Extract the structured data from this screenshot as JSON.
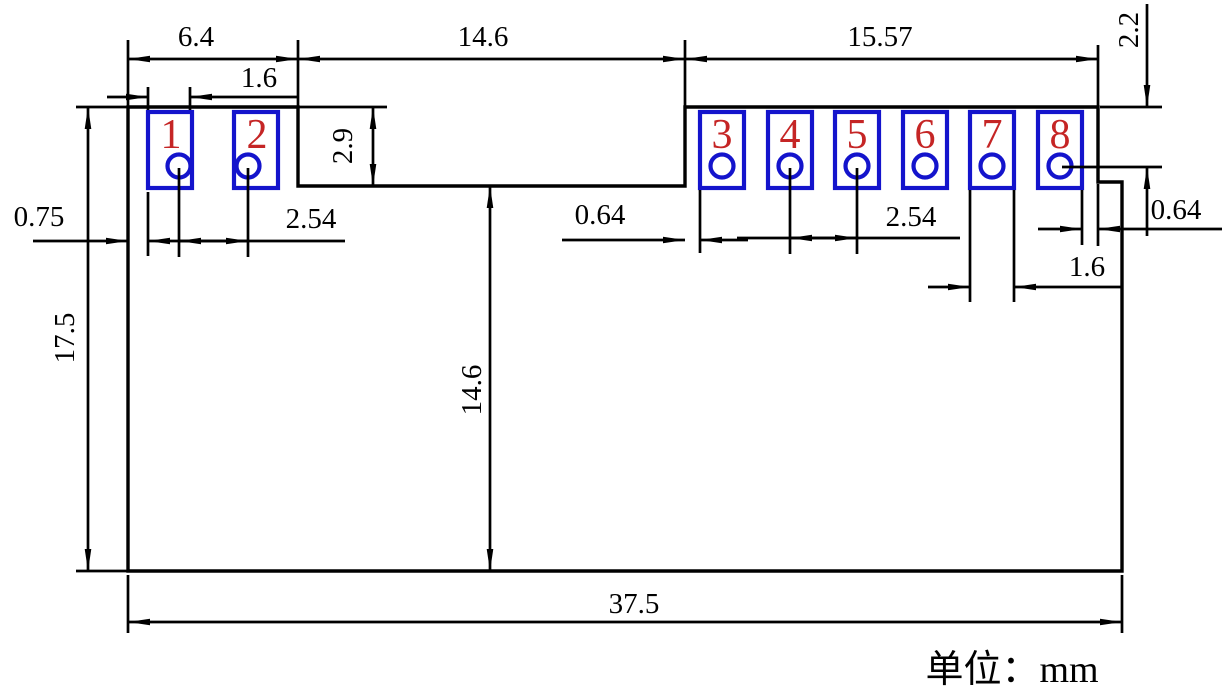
{
  "drawing": {
    "unit_note": "单位：mm",
    "pad_numbers": [
      "1",
      "2",
      "3",
      "4",
      "5",
      "6",
      "7",
      "8"
    ],
    "dims": {
      "top_left_width": "6.4",
      "top_middle_width": "14.6",
      "top_right_width": "15.57",
      "pad1_width": "1.6",
      "step_height": "2.9",
      "left_edge_to_pad": "0.75",
      "left_hole_pitch": "2.54",
      "right_block_inset": "0.64",
      "right_hole_pitch": "2.54",
      "pad8_edge_inset": "0.64",
      "pad7_width": "1.6",
      "top_to_hole": "2.2",
      "total_height": "17.5",
      "notch_depth": "14.6",
      "total_width": "37.5"
    },
    "colors": {
      "line": "#000000",
      "pad_outline": "#1414cc",
      "pad_number": "#c52525"
    }
  }
}
